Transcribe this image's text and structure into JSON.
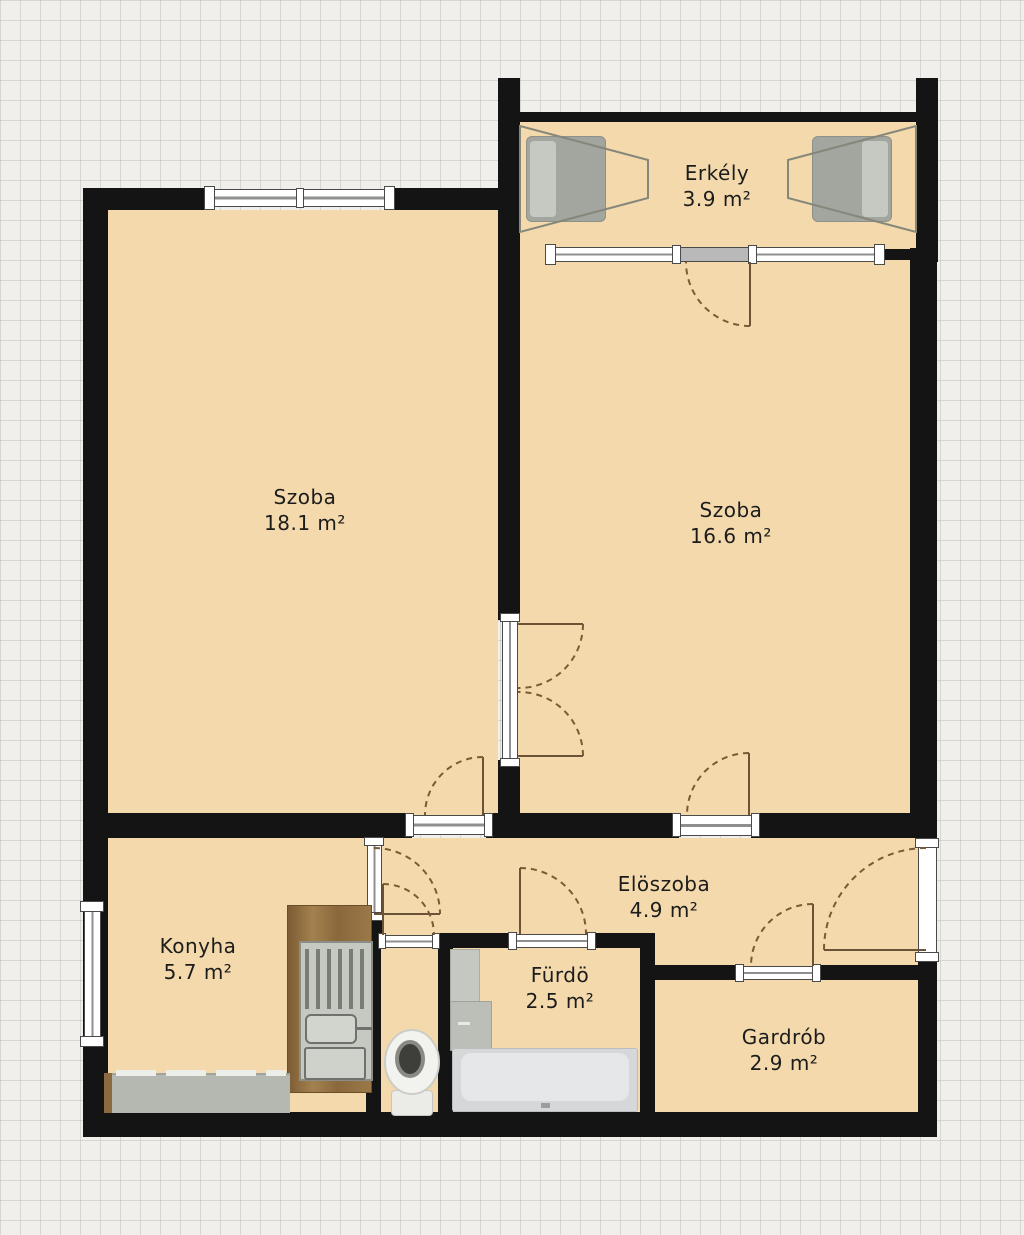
{
  "plan": {
    "type": "apartment-floor-plan",
    "rooms": [
      {
        "id": "erkely",
        "name": "Erkély",
        "area": "3.9 m²",
        "area_value": 3.9
      },
      {
        "id": "szoba-1",
        "name": "Szoba",
        "area": "18.1 m²",
        "area_value": 18.1
      },
      {
        "id": "szoba-2",
        "name": "Szoba",
        "area": "16.6 m²",
        "area_value": 16.6
      },
      {
        "id": "konyha",
        "name": "Konyha",
        "area": "5.7 m²",
        "area_value": 5.7
      },
      {
        "id": "eloszoba",
        "name": "Elöszoba",
        "area": "4.9 m²",
        "area_value": 4.9
      },
      {
        "id": "furdo",
        "name": "Fürdö",
        "area": "2.5 m²",
        "area_value": 2.5
      },
      {
        "id": "gardrob",
        "name": "Gardrób",
        "area": "2.9 m²",
        "area_value": 2.9
      }
    ],
    "colors": {
      "background": "#f0efec",
      "floor": "#f3d9ab",
      "wall": "#141414",
      "door_arc": "#7b5a36",
      "window_frame": "#ffffff",
      "counter": "#b5b8b0",
      "wood_cabinet": "#8a6a3e",
      "fixture_gray": "#d5d7d9"
    }
  }
}
